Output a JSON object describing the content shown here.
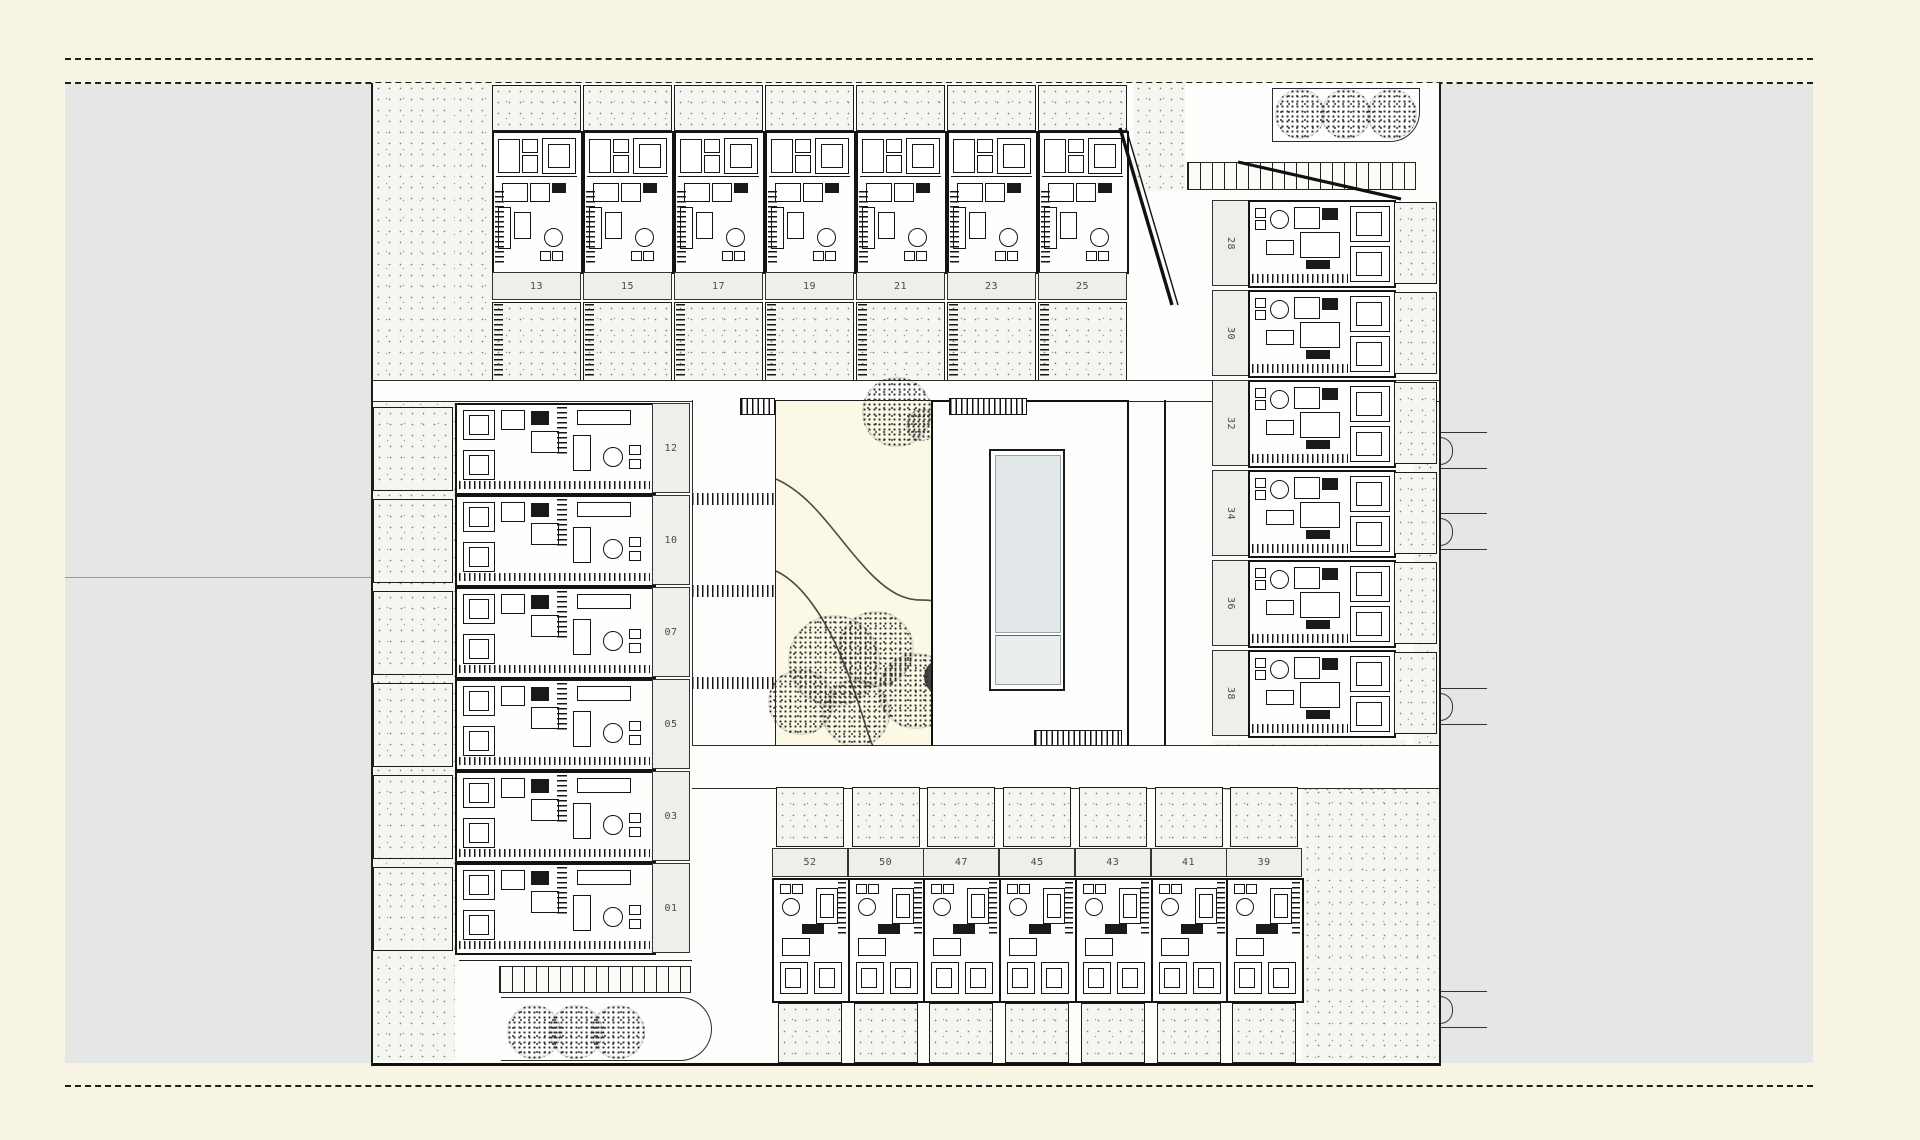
{
  "drawing": {
    "type": "architectural-site-plan",
    "sheet_background": "#f7f4e3",
    "parcel_color": "#e5e7e5",
    "line_color": "#1c1c1c",
    "pool_water_color": "#e2e8e9",
    "garden_color": "#fbf8e6"
  },
  "units": {
    "top_row": [
      {
        "number": "13"
      },
      {
        "number": "15"
      },
      {
        "number": "17"
      },
      {
        "number": "19"
      },
      {
        "number": "21"
      },
      {
        "number": "23"
      },
      {
        "number": "25"
      }
    ],
    "left_column": [
      {
        "number": "12"
      },
      {
        "number": "10"
      },
      {
        "number": "07"
      },
      {
        "number": "05"
      },
      {
        "number": "03"
      },
      {
        "number": "01"
      }
    ],
    "right_column": [
      {
        "number": "28"
      },
      {
        "number": "30"
      },
      {
        "number": "32"
      },
      {
        "number": "34"
      },
      {
        "number": "36"
      },
      {
        "number": "38"
      }
    ],
    "bottom_row": [
      {
        "number": "52"
      },
      {
        "number": "50"
      },
      {
        "number": "47"
      },
      {
        "number": "45"
      },
      {
        "number": "43"
      },
      {
        "number": "41"
      },
      {
        "number": "39"
      }
    ]
  },
  "landscape": {
    "courtyard": {
      "garden_trees": 6,
      "pool": "rectangular lap pool with shallow step"
    },
    "top_right_tree_bed_trees": 3,
    "bottom_left_tree_bed_trees": 3,
    "parking_strips": 2
  }
}
